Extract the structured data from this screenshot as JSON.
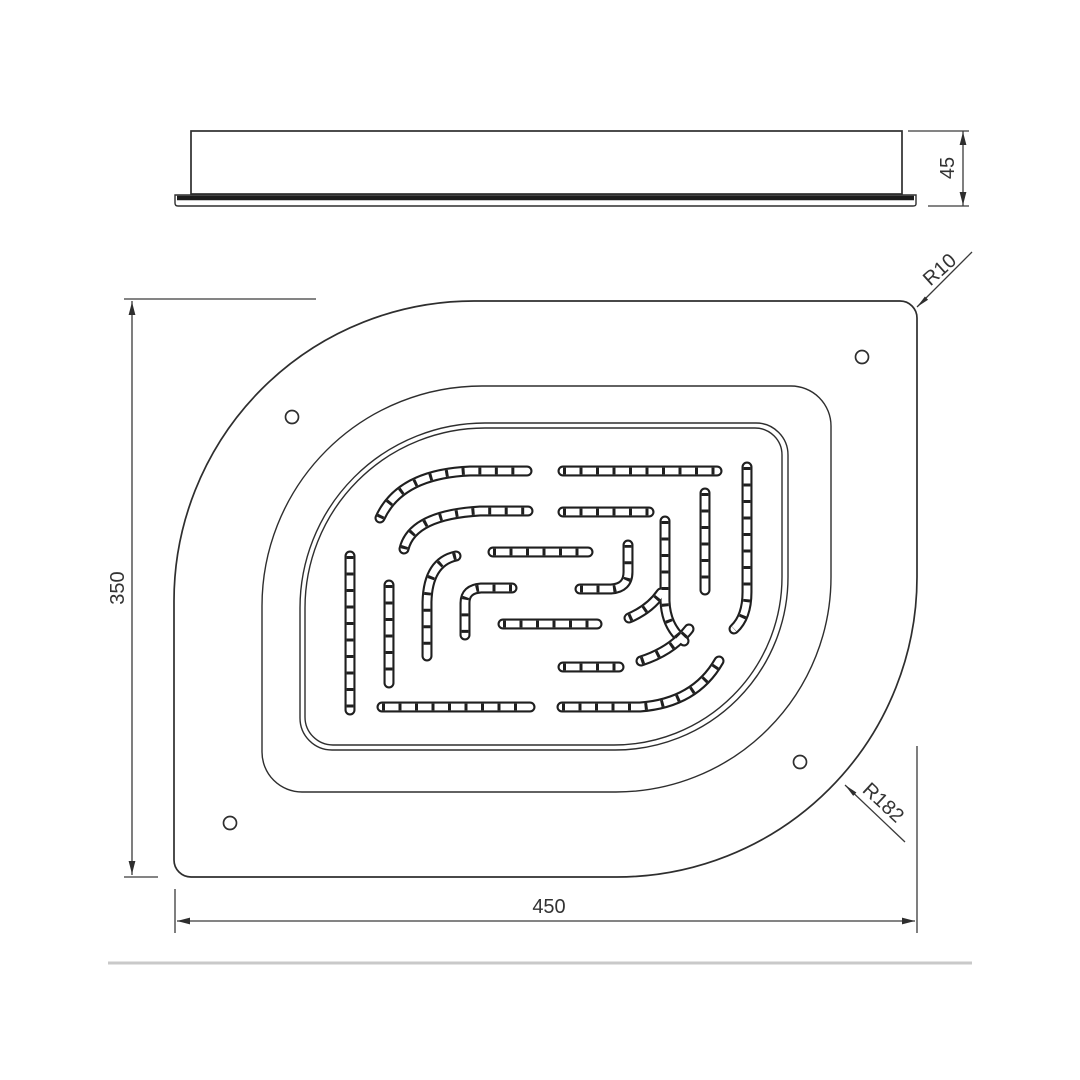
{
  "drawing": {
    "title": "overhead-shower-technical-drawing",
    "labels": {
      "side_height": "45",
      "plan_height": "350",
      "plan_width": "450",
      "radius_small": "R10",
      "radius_large": "R182"
    },
    "colors": {
      "line": "#2e2e2e",
      "divider": "#c9c9c9",
      "background": "#ffffff"
    }
  }
}
